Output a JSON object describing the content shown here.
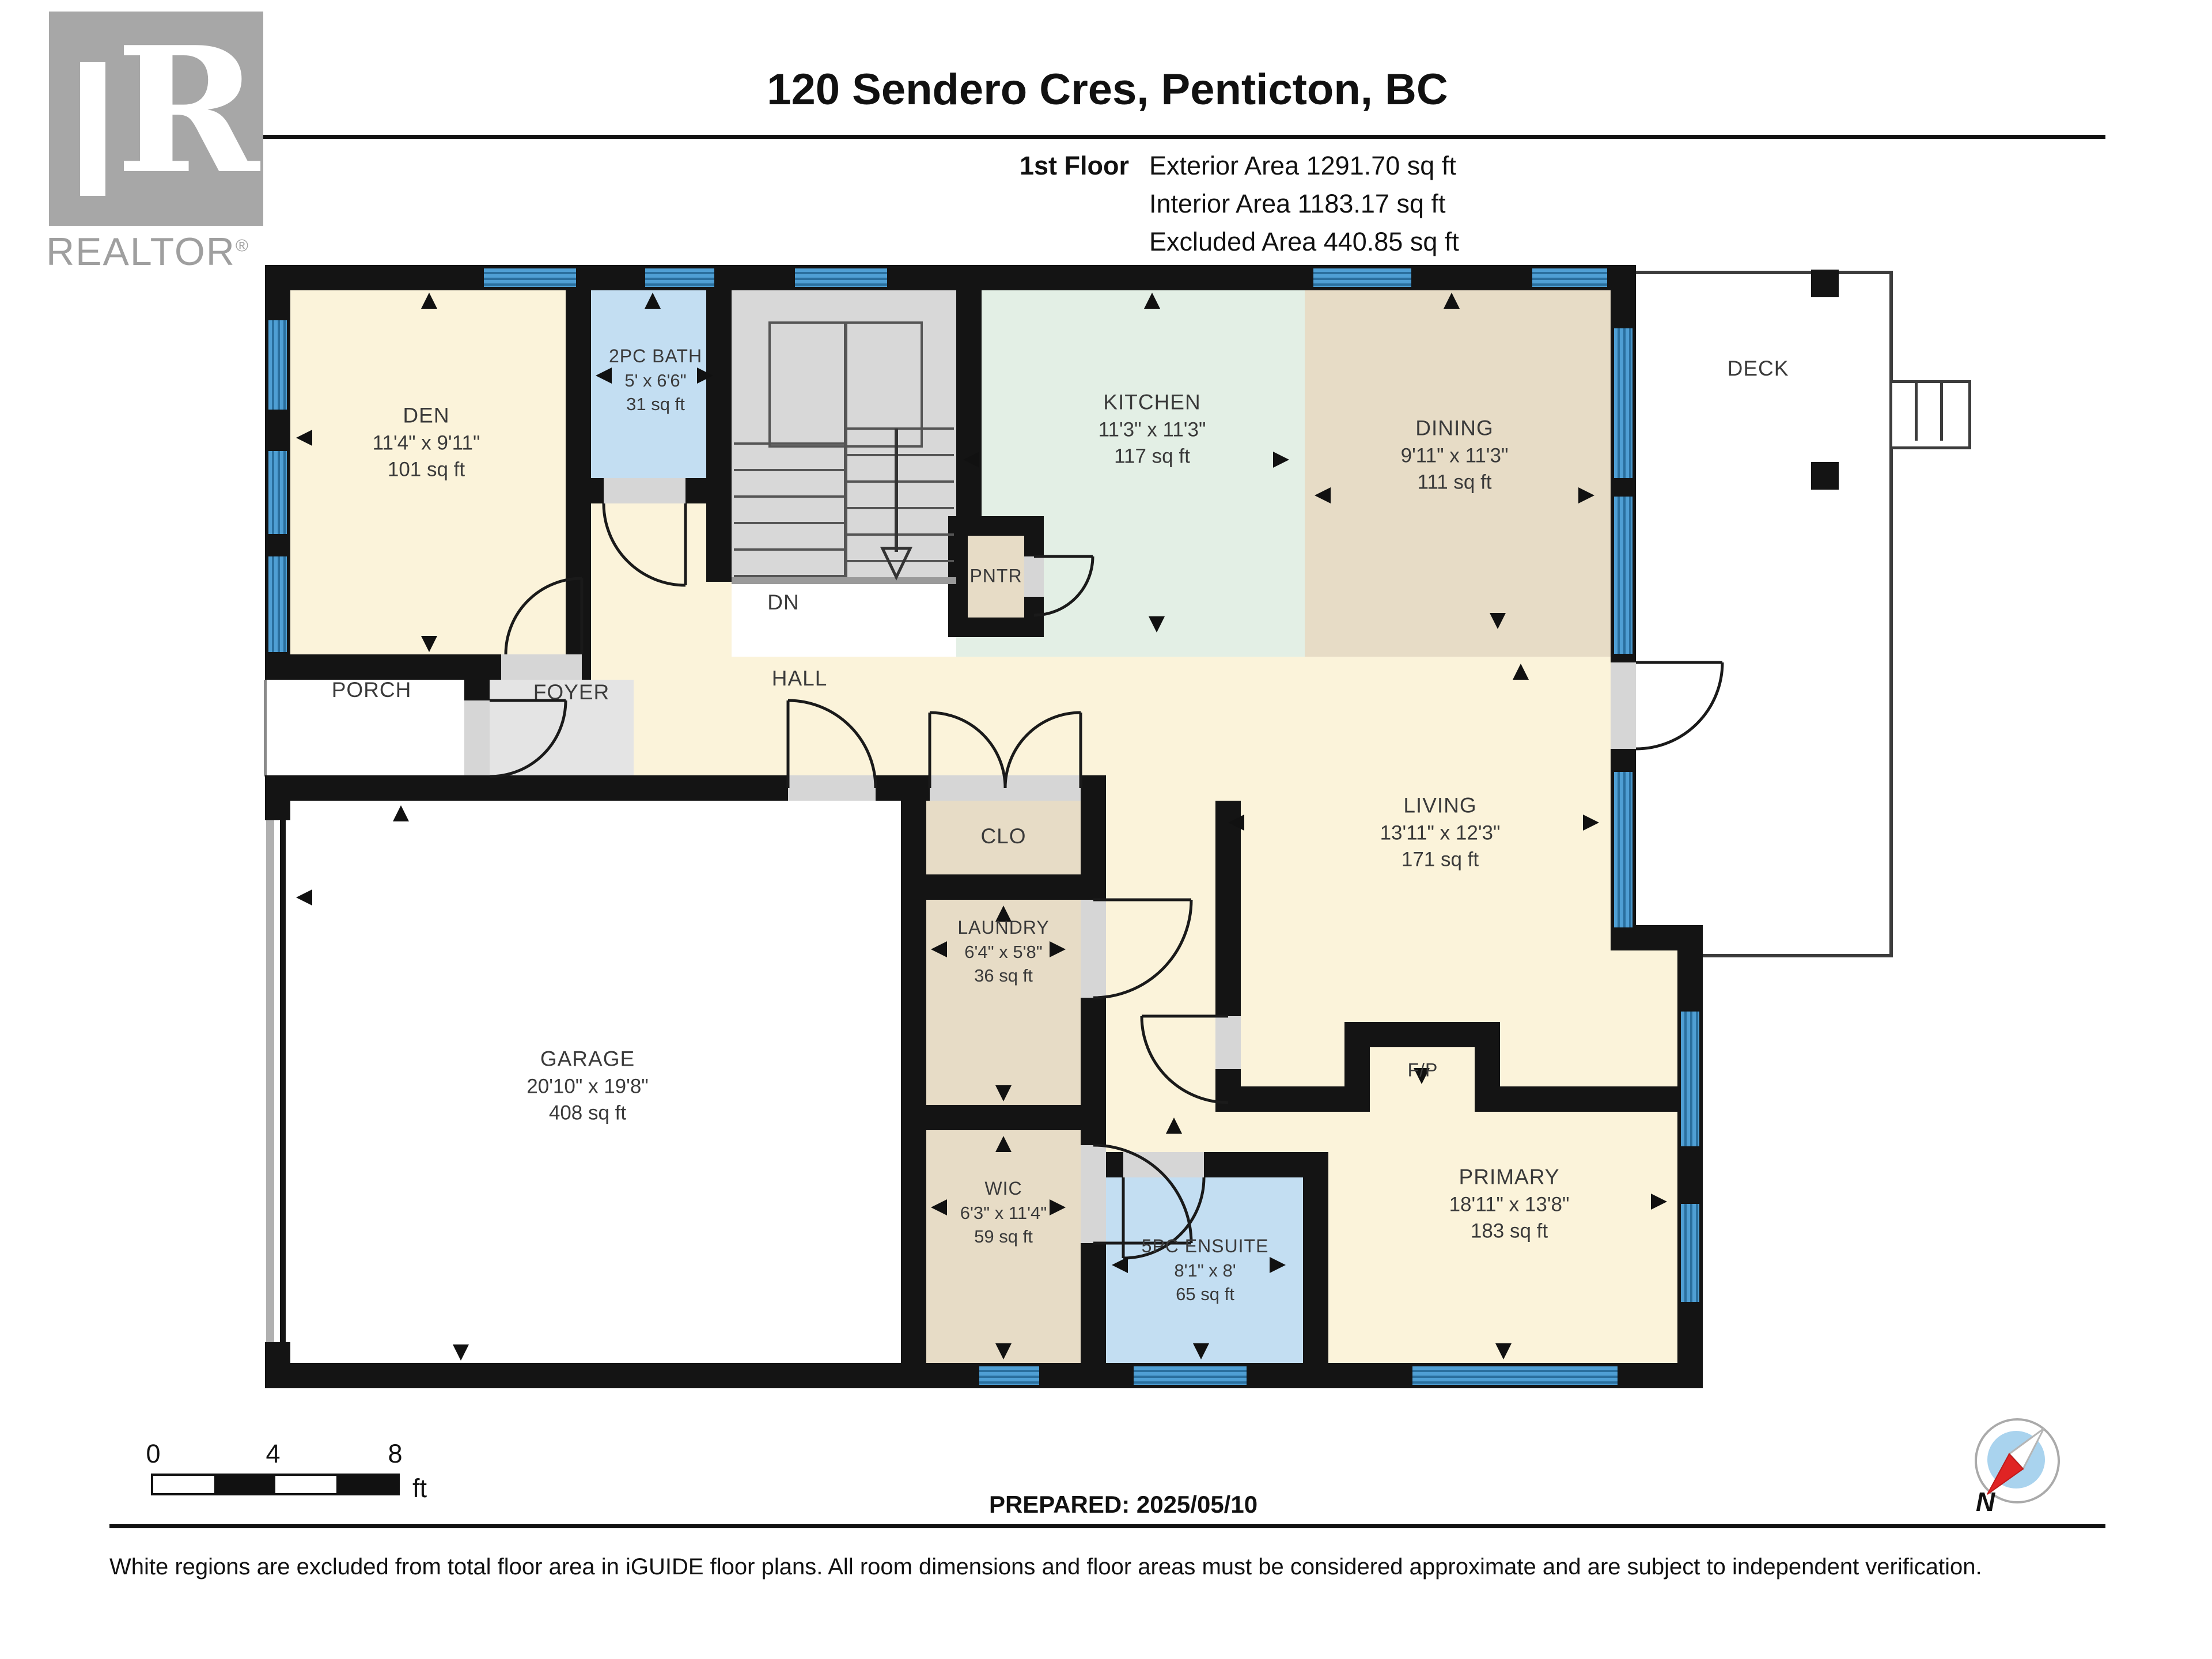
{
  "logo": {
    "letter": "R",
    "brand": "REALTOR",
    "registered": "®"
  },
  "header": {
    "title": "120 Sendero Cres, Penticton, BC",
    "floor_label": "1st Floor",
    "stats": [
      "Exterior Area 1291.70 sq ft",
      "Interior Area 1183.17 sq ft",
      "Excluded Area 440.85 sq ft"
    ]
  },
  "rooms": {
    "den": {
      "name": "DEN",
      "dims": "11'4\" x 9'11\"",
      "area": "101 sq ft"
    },
    "bath": {
      "name": "2PC BATH",
      "dims": "5' x 6'6\"",
      "area": "31 sq ft"
    },
    "kitchen": {
      "name": "KITCHEN",
      "dims": "11'3\" x 11'3\"",
      "area": "117 sq ft"
    },
    "dining": {
      "name": "DINING",
      "dims": "9'11\" x 11'3\"",
      "area": "111 sq ft"
    },
    "living": {
      "name": "LIVING",
      "dims": "13'11\" x 12'3\"",
      "area": "171 sq ft"
    },
    "garage": {
      "name": "GARAGE",
      "dims": "20'10\" x 19'8\"",
      "area": "408 sq ft"
    },
    "laundry": {
      "name": "LAUNDRY",
      "dims": "6'4\" x 5'8\"",
      "area": "36 sq ft"
    },
    "wic": {
      "name": "WIC",
      "dims": "6'3\" x 11'4\"",
      "area": "59 sq ft"
    },
    "ensuite": {
      "name": "5PC ENSUITE",
      "dims": "8'1\" x 8'",
      "area": "65 sq ft"
    },
    "primary": {
      "name": "PRIMARY",
      "dims": "18'11\" x 13'8\"",
      "area": "183 sq ft"
    },
    "deck": {
      "name": "DECK"
    },
    "porch": {
      "name": "PORCH"
    },
    "foyer": {
      "name": "FOYER"
    },
    "hall": {
      "name": "HALL"
    },
    "pntr": {
      "name": "PNTR"
    },
    "clo": {
      "name": "CLO"
    },
    "dn": {
      "name": "DN"
    },
    "fp": {
      "name": "F/P"
    }
  },
  "footer": {
    "scale_ticks": [
      "0",
      "4",
      "8"
    ],
    "scale_unit": "ft",
    "prepared": "PREPARED: 2025/05/10",
    "compass_n": "N",
    "disclaimer": "White regions are excluded from total floor area in iGUIDE floor plans. All room dimensions and floor areas must be considered approximate and are subject to independent verification."
  }
}
